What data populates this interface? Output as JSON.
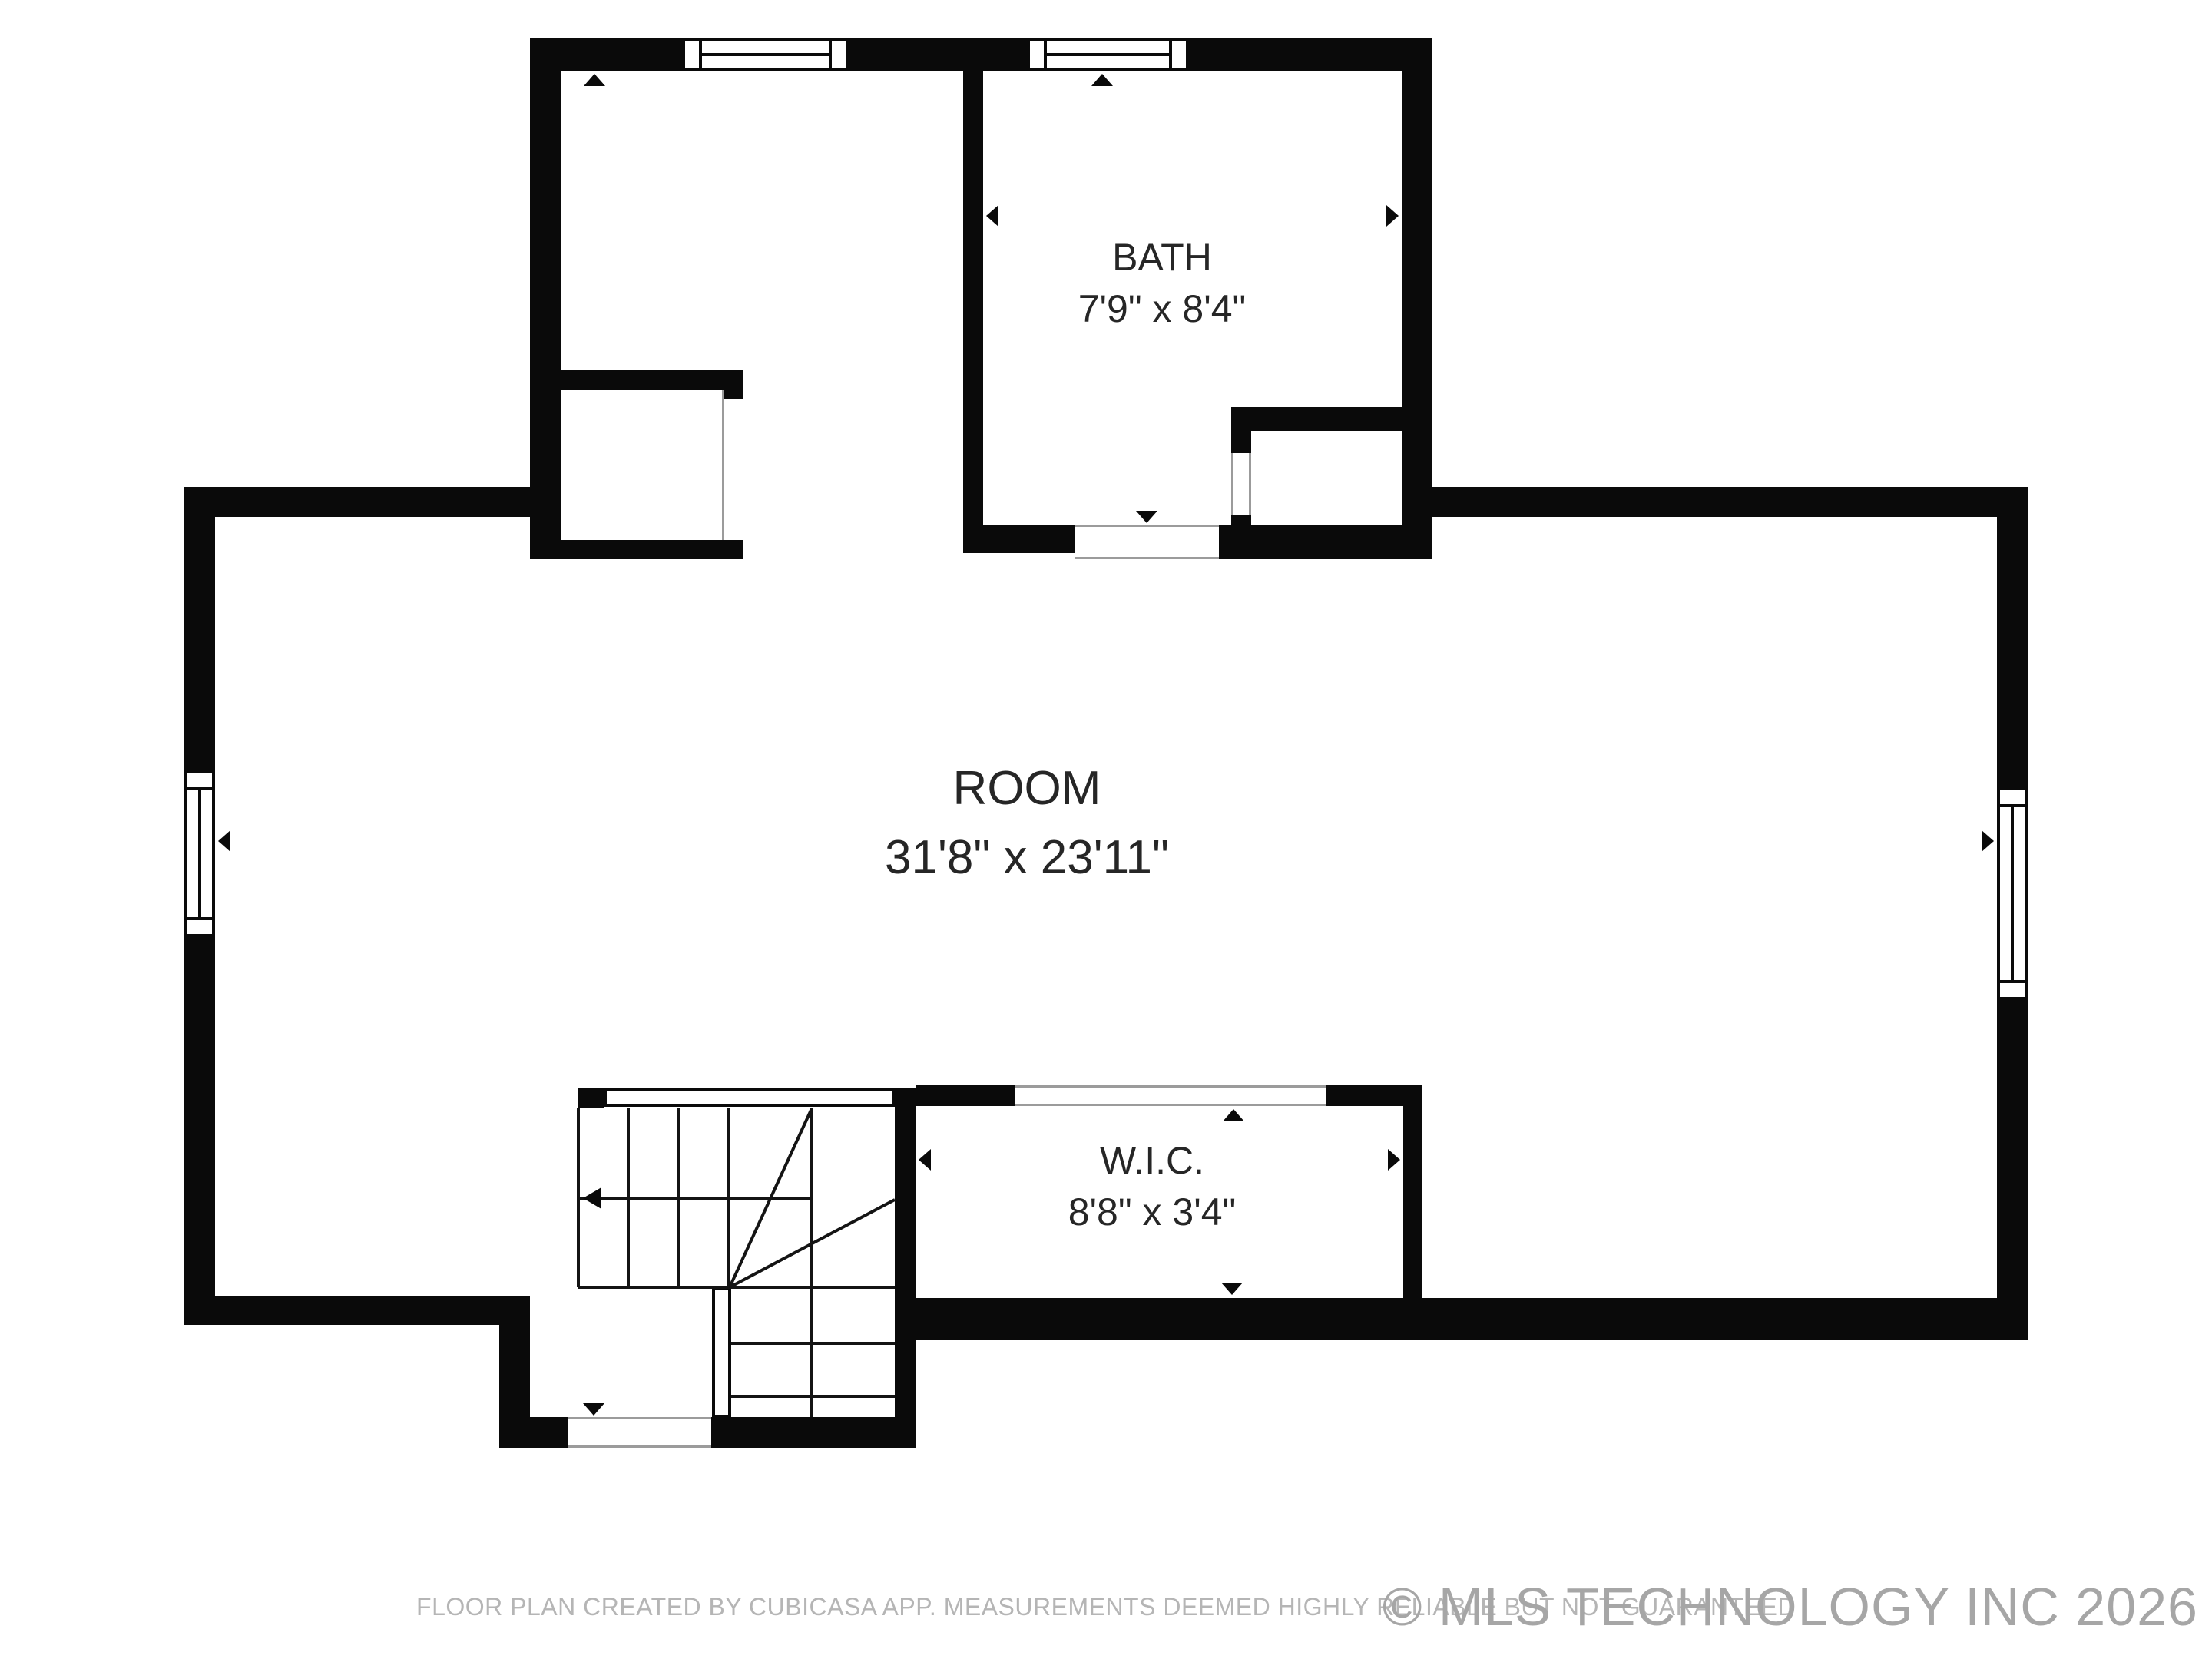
{
  "floor_plan": {
    "rooms": [
      {
        "name": "BATH",
        "dimensions": "7'9\" x 8'4\""
      },
      {
        "name": "ROOM",
        "dimensions": "31'8\" x 23'11\""
      },
      {
        "name": "W.I.C.",
        "dimensions": "8'8\" x 3'4\""
      }
    ],
    "footer_disclaimer": "FLOOR PLAN CREATED BY CUBICASA APP. MEASUREMENTS DEEMED HIGHLY RELIABLE BUT NOT GUARANTEED",
    "watermark": "© MLS TECHNOLOGY INC 2026",
    "colors": {
      "wall": "#0a0a0a",
      "text": "#262626",
      "muted": "#b5b5b5",
      "watermark": "#a6a6a6",
      "door_line": "#9b9b9b"
    }
  }
}
